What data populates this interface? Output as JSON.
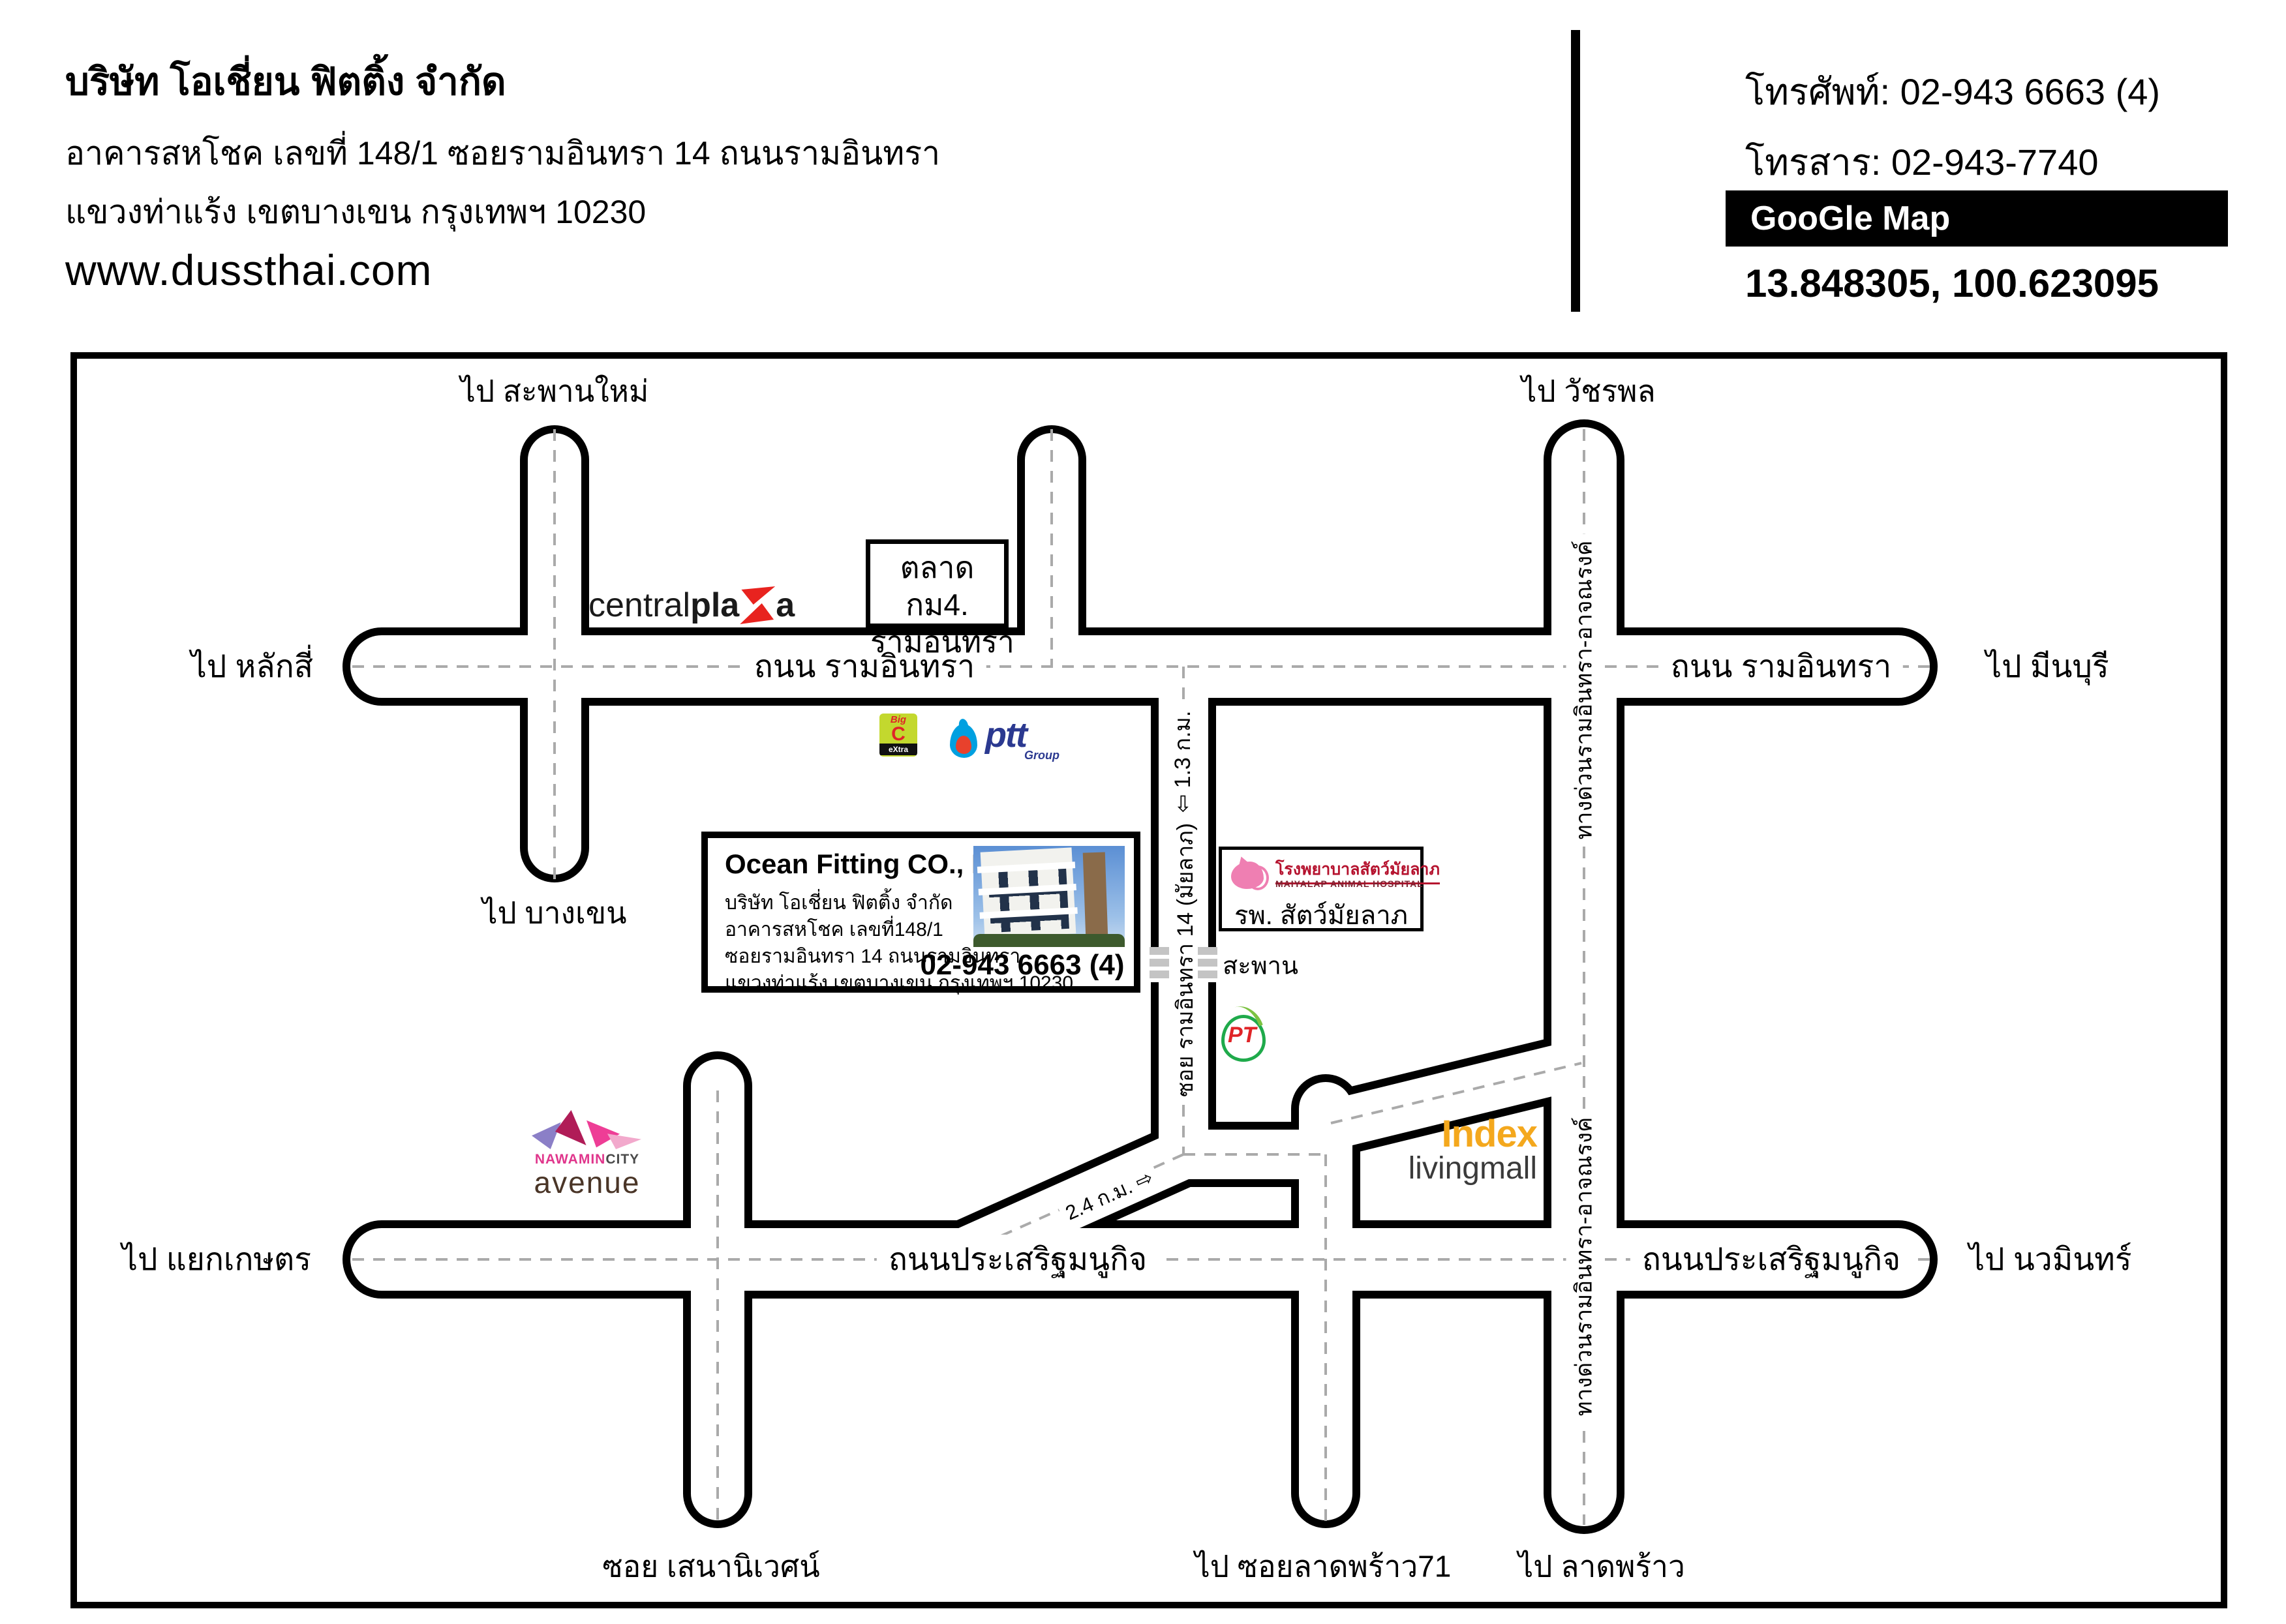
{
  "header": {
    "company": "บริษัท โอเชี่ยน ฟิตติ้ง จำกัด",
    "address_line1": "อาคารสหโชค เลขที่ 148/1 ซอยรามอินทรา 14 ถนนรามอินทรา",
    "address_line2": "แขวงท่าแร้ง เขตบางเขน กรุงเทพฯ 10230",
    "website": "www.dussthai.com",
    "phone": "โทรศัพท์: 02-943 6663 (4)",
    "fax": "โทรสาร:  02-943-7740",
    "google_map_badge": "GooGle Map",
    "coordinates": "13.848305, 100.623095"
  },
  "map": {
    "to_saphan_mai": "ไป สะพานใหม่",
    "to_watcharapol": "ไป วัชรพล",
    "to_lak_si": "ไป หลักสี่",
    "to_min_buri": "ไป มีนบุรี",
    "to_bang_khen": "ไป บางเขน",
    "to_yaek_kaset": "ไป แยกเกษตร",
    "to_nawamin": "ไป นวมินทร์",
    "to_soi_ladprao71": "ไป ซอยลาดพร้าว71",
    "to_ladprao": "ไป ลาดพร้าว",
    "soi_sena_nivet": "ซอย เสนานิเวศน์",
    "road_ram_inthra": "ถนน รามอินทรา",
    "road_prasert_manukit": "ถนนประเสริฐมนูกิจ",
    "expressway": "ทางด่วนรามอินทรา-อาจณรงค์",
    "soi_ram_inthra14": "ซอย รามอินทรา 14 (มัยลาภ)",
    "distance_1_3": "1.3 ก.ม.",
    "distance_2_4": "2.4 ก.ม.",
    "arrow_open_left": "⇦",
    "arrow_open_right": "⇨",
    "bridge": "สะพาน",
    "market_line1": "ตลาด กม4.",
    "market_line2": "รามอินทรา"
  },
  "landmarks": {
    "central_plaza": {
      "part1": "central",
      "part2": "pla",
      "part3": "a"
    },
    "big_c": {
      "big": "Big",
      "c": "C",
      "extra": "eXtra"
    },
    "ptt": {
      "name": "ptt",
      "group": "Group"
    },
    "pt_station": {
      "name": "PT"
    },
    "index_livingmall": {
      "name": "Index",
      "sub": "livingmall"
    },
    "nawamin_city": {
      "name": "NAWAMIN",
      "city": "CITY",
      "avenue": "avenue"
    },
    "maiyalap_hospital": {
      "thai": "โรงพยาบาลสัตว์มัยลาภ",
      "english": "MAIYALAP ANIMAL HOSPITAL",
      "short": "รพ. สัตว์มัยลาภ"
    }
  },
  "ocean_box": {
    "title": "Ocean Fitting CO., LTD.",
    "line1": "บริษัท โอเชี่ยน ฟิตติ้ง จำกัด",
    "line2": "อาคารสหโชค เลขที่148/1",
    "line3": "ซอยรามอินทรา 14 ถนนรามอินทรา",
    "line4": "แขวงท่าแร้ง เขตบางเขน กรุงเทพฯ 10230",
    "phone": "02-943 6663 (4)"
  },
  "colors": {
    "road_outline": "#000000",
    "road_fill": "#ffffff",
    "dash_line": "#aaaaaa",
    "central_red": "#e8231f",
    "bigc_green": "#c3d82e",
    "bigc_red": "#e02427",
    "ptt_blue": "#2b3990",
    "ptt_flame_blue": "#00a0e0",
    "ptt_flame_red": "#e8412c",
    "pt_green": "#1faa4b",
    "index_orange": "#f4a81d",
    "nawamin_pink": "#e0368c",
    "hospital_pink": "#ef7fb2",
    "hospital_red": "#b5122e"
  }
}
